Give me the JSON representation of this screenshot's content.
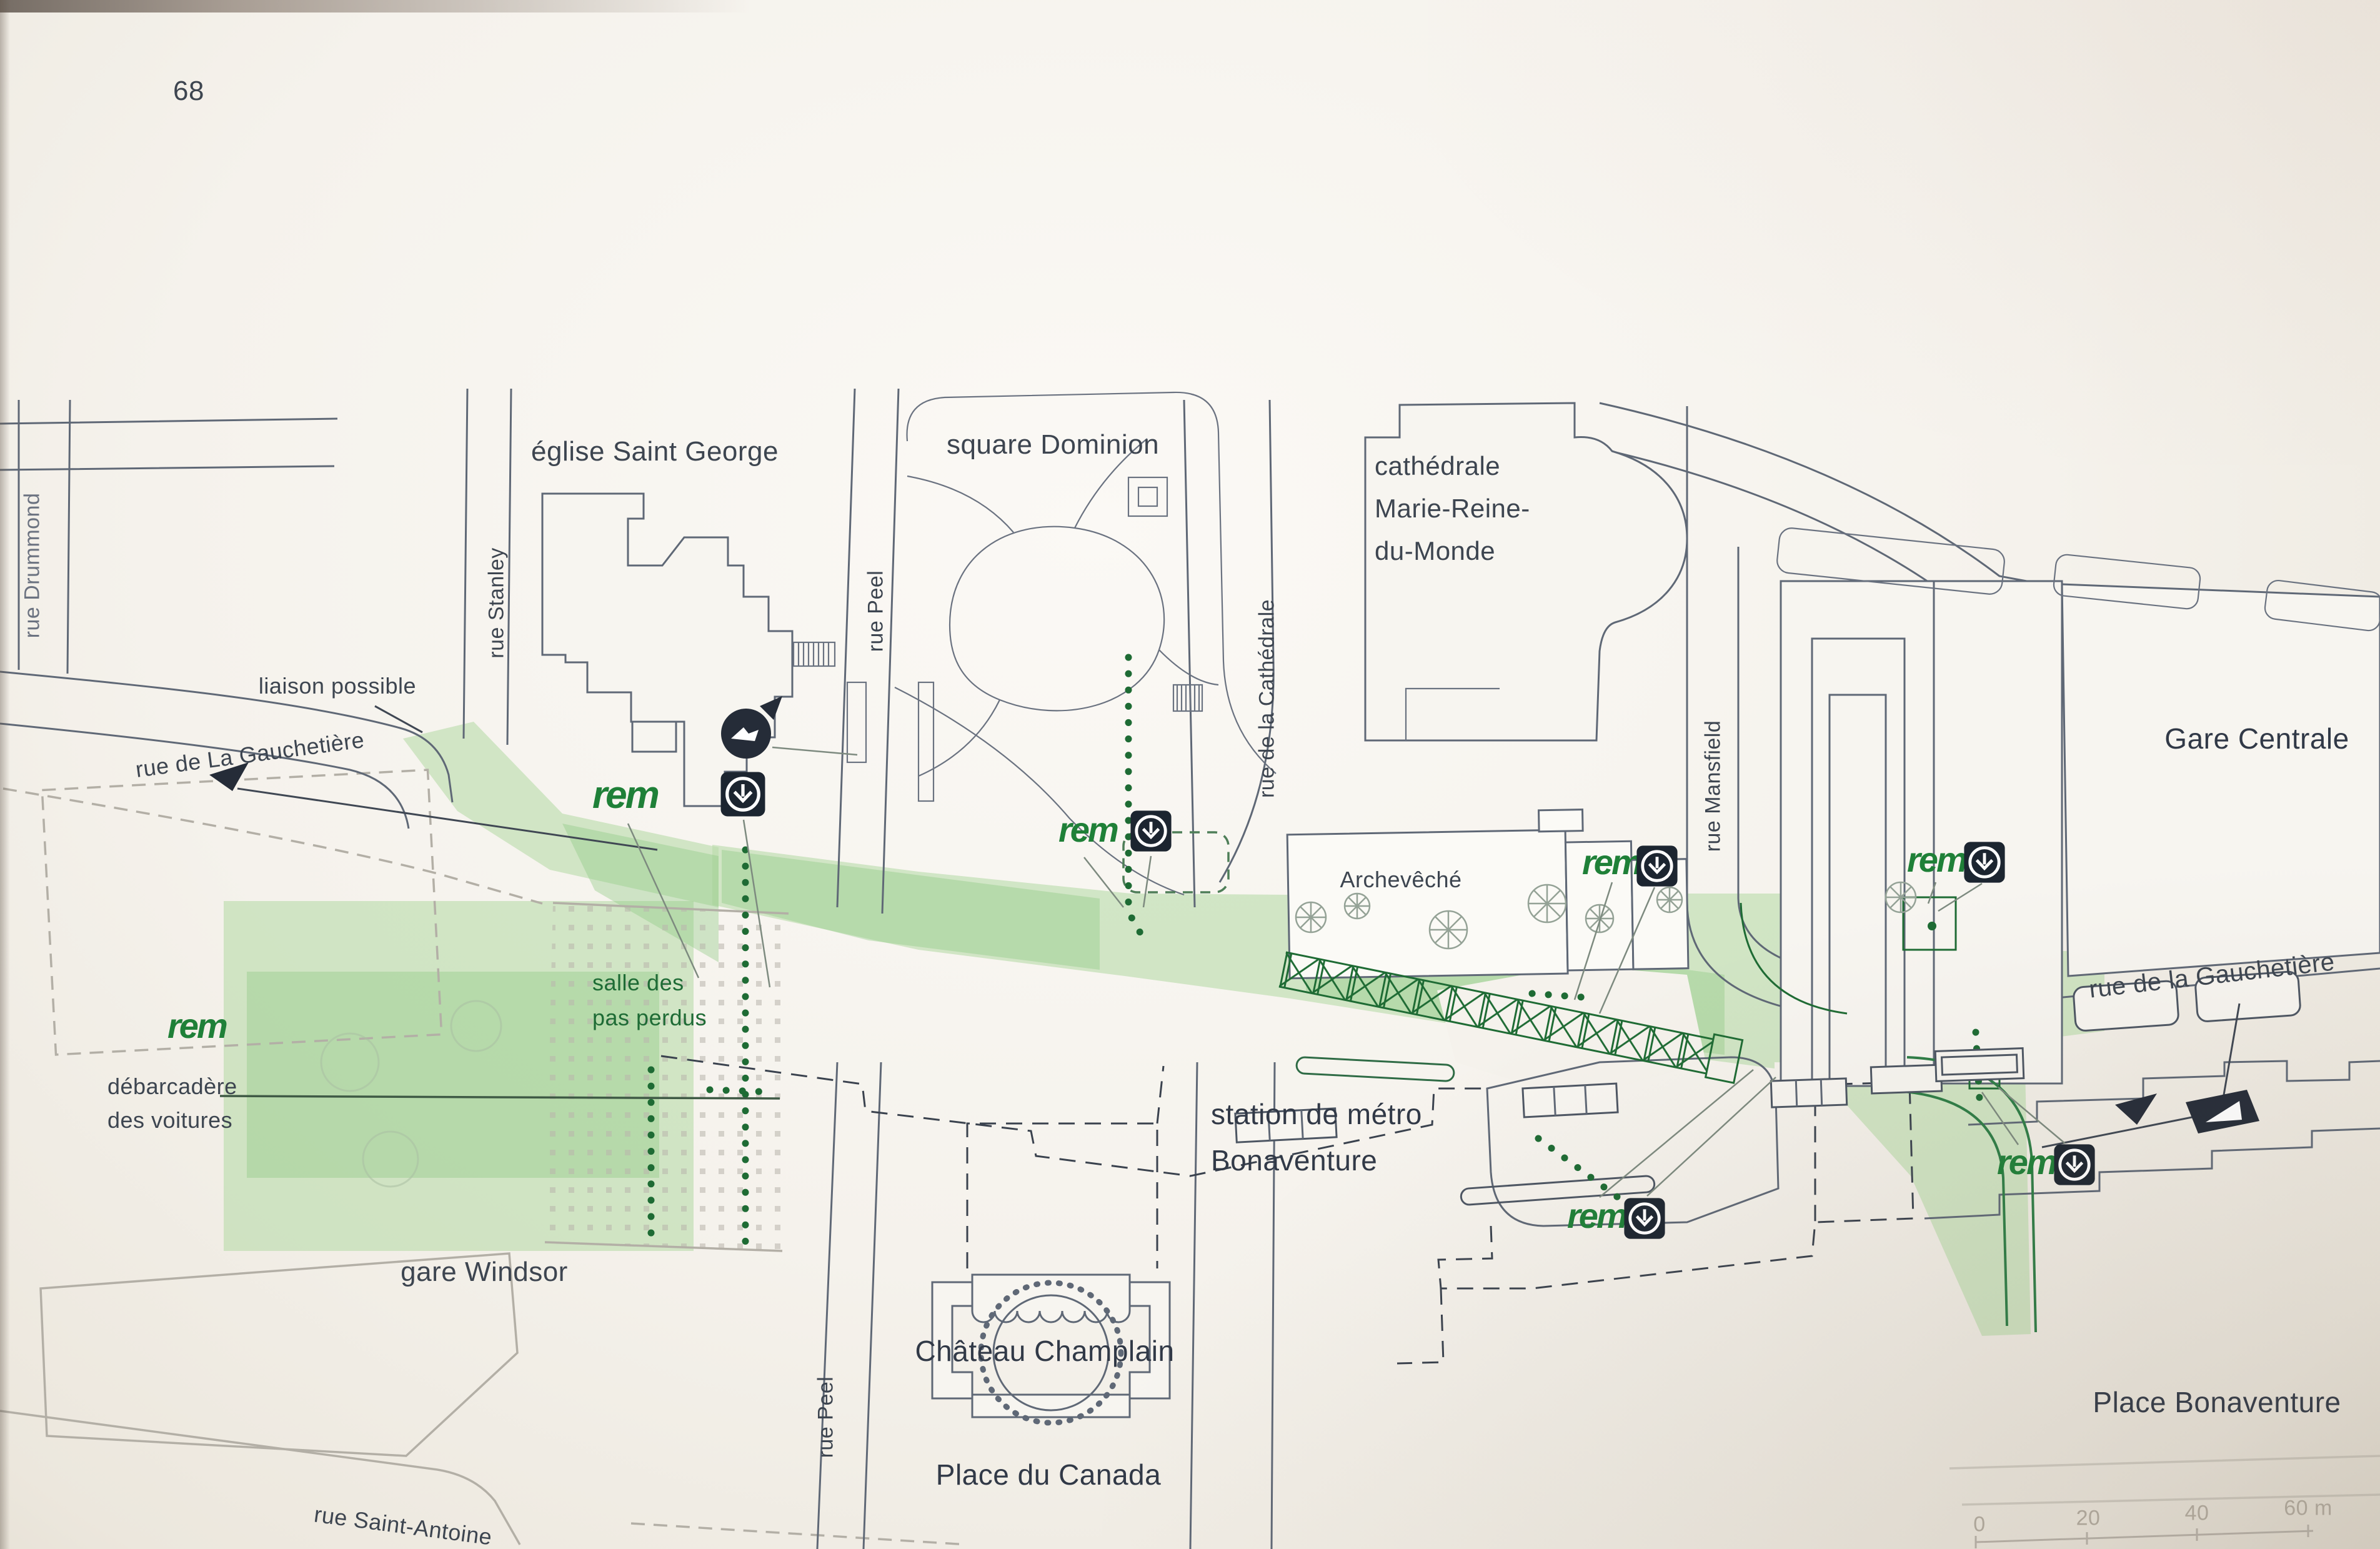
{
  "page": {
    "number": "68"
  },
  "colors": {
    "network_green": "#b9dcab",
    "network_green_dark": "#8cc981",
    "accent_green": "#1e6b34",
    "rem_green": "#1f8038",
    "metro_badge": "#1c2530",
    "ink": "#3d4550",
    "paper": "#f5f2ec"
  },
  "labels": {
    "eglise": "église Saint George",
    "square_dominion": "square Dominion",
    "cathedrale_l1": "cathédrale",
    "cathedrale_l2": "Marie-Reine-",
    "cathedrale_l3": "du-Monde",
    "gare_centrale": "Gare Centrale",
    "rue_drummond": "rue Drummond",
    "rue_stanley": "rue Stanley",
    "rue_peel_top": "rue Peel",
    "rue_peel_bottom": "rue Peel",
    "rue_cathedrale": "rue de la Cathédrale",
    "rue_mansfield": "rue Mansfield",
    "liaison": "liaison possible",
    "gauchetiere_left": "rue de La Gauchetière",
    "gauchetiere_right": "rue de la Gauchetière",
    "salle_l1": "salle des",
    "salle_l2": "pas perdus",
    "debarcadere_l1": "débarcadère",
    "debarcadere_l2": "des voitures",
    "gare_windsor": "gare Windsor",
    "archeveche": "Archevêché",
    "station_l1": "station de métro",
    "station_l2": "Bonaventure",
    "chateau": "Château Champlain",
    "place_canada": "Place du Canada",
    "rue_st_antoine": "rue Saint-Antoine",
    "place_bonaventure": "Place Bonaventure"
  },
  "icons": {
    "rem_text": "rem",
    "metro_icon_name": "metro-down-arrow-icon"
  },
  "scale_bar": {
    "ticks": [
      "0",
      "20",
      "40",
      "60 m"
    ]
  }
}
